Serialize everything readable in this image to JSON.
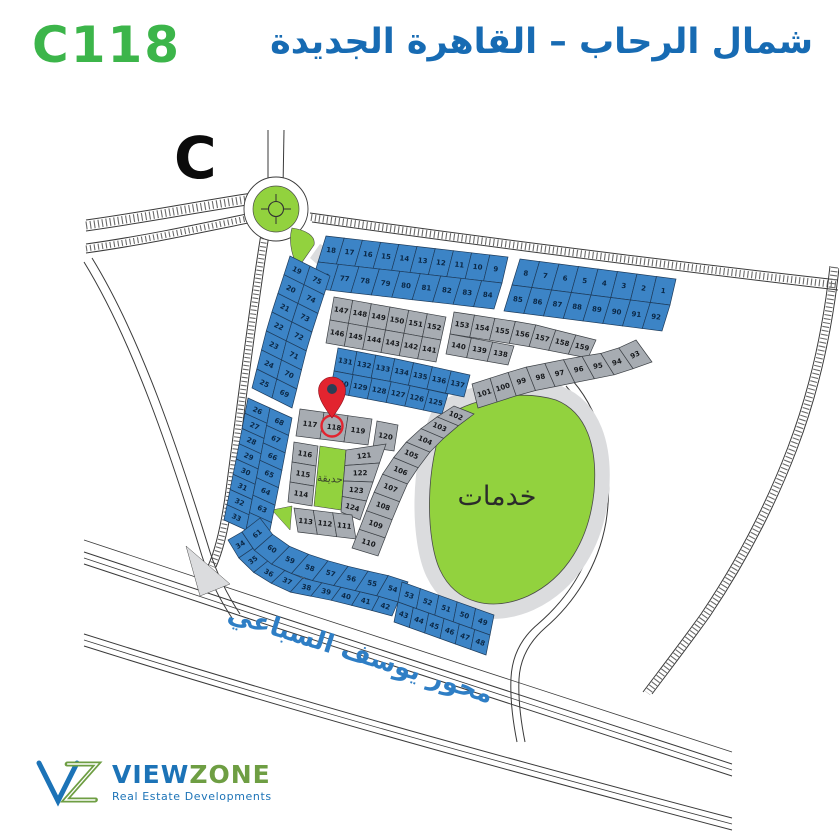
{
  "header": {
    "plot_code": "C118",
    "title_ar": "شمال الرحاب – القاهرة الجديدة"
  },
  "map": {
    "sector_letter": "C",
    "services_label": "خدمات",
    "garden_label": "حديقة",
    "road_label": "محور يوسف السباعي",
    "pinned_plot": "118",
    "plots": {
      "top_left_row1": [
        "18",
        "17",
        "16",
        "15",
        "14",
        "13",
        "12",
        "11",
        "10",
        "9"
      ],
      "top_left_row2": [
        "76",
        "77",
        "78",
        "79",
        "80",
        "81",
        "82",
        "83",
        "84"
      ],
      "top_right_row1": [
        "8",
        "7",
        "6",
        "5",
        "4",
        "3",
        "2",
        "1"
      ],
      "top_right_row2": [
        "85",
        "86",
        "87",
        "88",
        "89",
        "90",
        "91",
        "92"
      ],
      "gray_a_row1": [
        "147",
        "148",
        "149",
        "150",
        "151",
        "152"
      ],
      "gray_a_row2": [
        "146",
        "145",
        "144",
        "143",
        "142",
        "141"
      ],
      "gray_b_row1": [
        "153",
        "154",
        "155",
        "156",
        "157",
        "158",
        "159"
      ],
      "gray_b_row2": [
        "140",
        "139",
        "138"
      ],
      "blue_mid_row1": [
        "131",
        "132",
        "133",
        "134",
        "135",
        "136",
        "137"
      ],
      "blue_mid_row2": [
        "130",
        "129",
        "128",
        "127",
        "126",
        "125"
      ],
      "left_outer_1": [
        "19",
        "20",
        "21",
        "22",
        "23",
        "24",
        "25"
      ],
      "left_inner_1": [
        "75",
        "74",
        "73",
        "72",
        "71",
        "70",
        "69"
      ],
      "left_outer_2": [
        "26",
        "27",
        "28",
        "29",
        "30",
        "31",
        "32",
        "33"
      ],
      "left_inner_2": [
        "68",
        "67",
        "66",
        "65",
        "64",
        "63",
        "62"
      ],
      "bottom_outer": [
        "34",
        "35",
        "36",
        "37",
        "38",
        "39",
        "40",
        "41",
        "42"
      ],
      "bottom_inner": [
        "61",
        "60",
        "59",
        "58",
        "57",
        "56",
        "55",
        "54"
      ],
      "block43_top": [
        "53",
        "52",
        "51",
        "50",
        "49"
      ],
      "block43_bottom": [
        "43",
        "44",
        "45",
        "46",
        "47",
        "48"
      ],
      "central_top": [
        "117",
        "118",
        "119"
      ],
      "central_120": [
        "120"
      ],
      "central_left": [
        "116",
        "115",
        "114"
      ],
      "central_right": [
        "121",
        "122",
        "123",
        "124"
      ],
      "central_bottom": [
        "113",
        "112",
        "111"
      ],
      "diag": [
        "110",
        "109",
        "108",
        "107",
        "106",
        "105",
        "104",
        "103",
        "102"
      ],
      "curve": [
        "101",
        "100",
        "99",
        "98",
        "97",
        "96",
        "95",
        "94",
        "93"
      ]
    }
  },
  "logo": {
    "name_part1": "VIEW",
    "name_part2": "ZONE",
    "tagline": "Real Estate Developments"
  },
  "theme": {
    "plot_blue": "#3c84c6",
    "plot_blue_stroke": "#1e3c5c",
    "plot_gray": "#a7acb2",
    "plot_gray_stroke": "#3c4045",
    "green": "#92d23e",
    "light_gray": "#dbdcde",
    "header_blue": "#176bb3",
    "header_green": "#3cb54a",
    "pin_red": "#e2242f",
    "number_on_blue": "#0b2846",
    "number_on_gray": "#17191c",
    "road_label_blue": "#2e7ec5",
    "logo_blue": "#1c73b7",
    "logo_green": "#6e9e43"
  }
}
